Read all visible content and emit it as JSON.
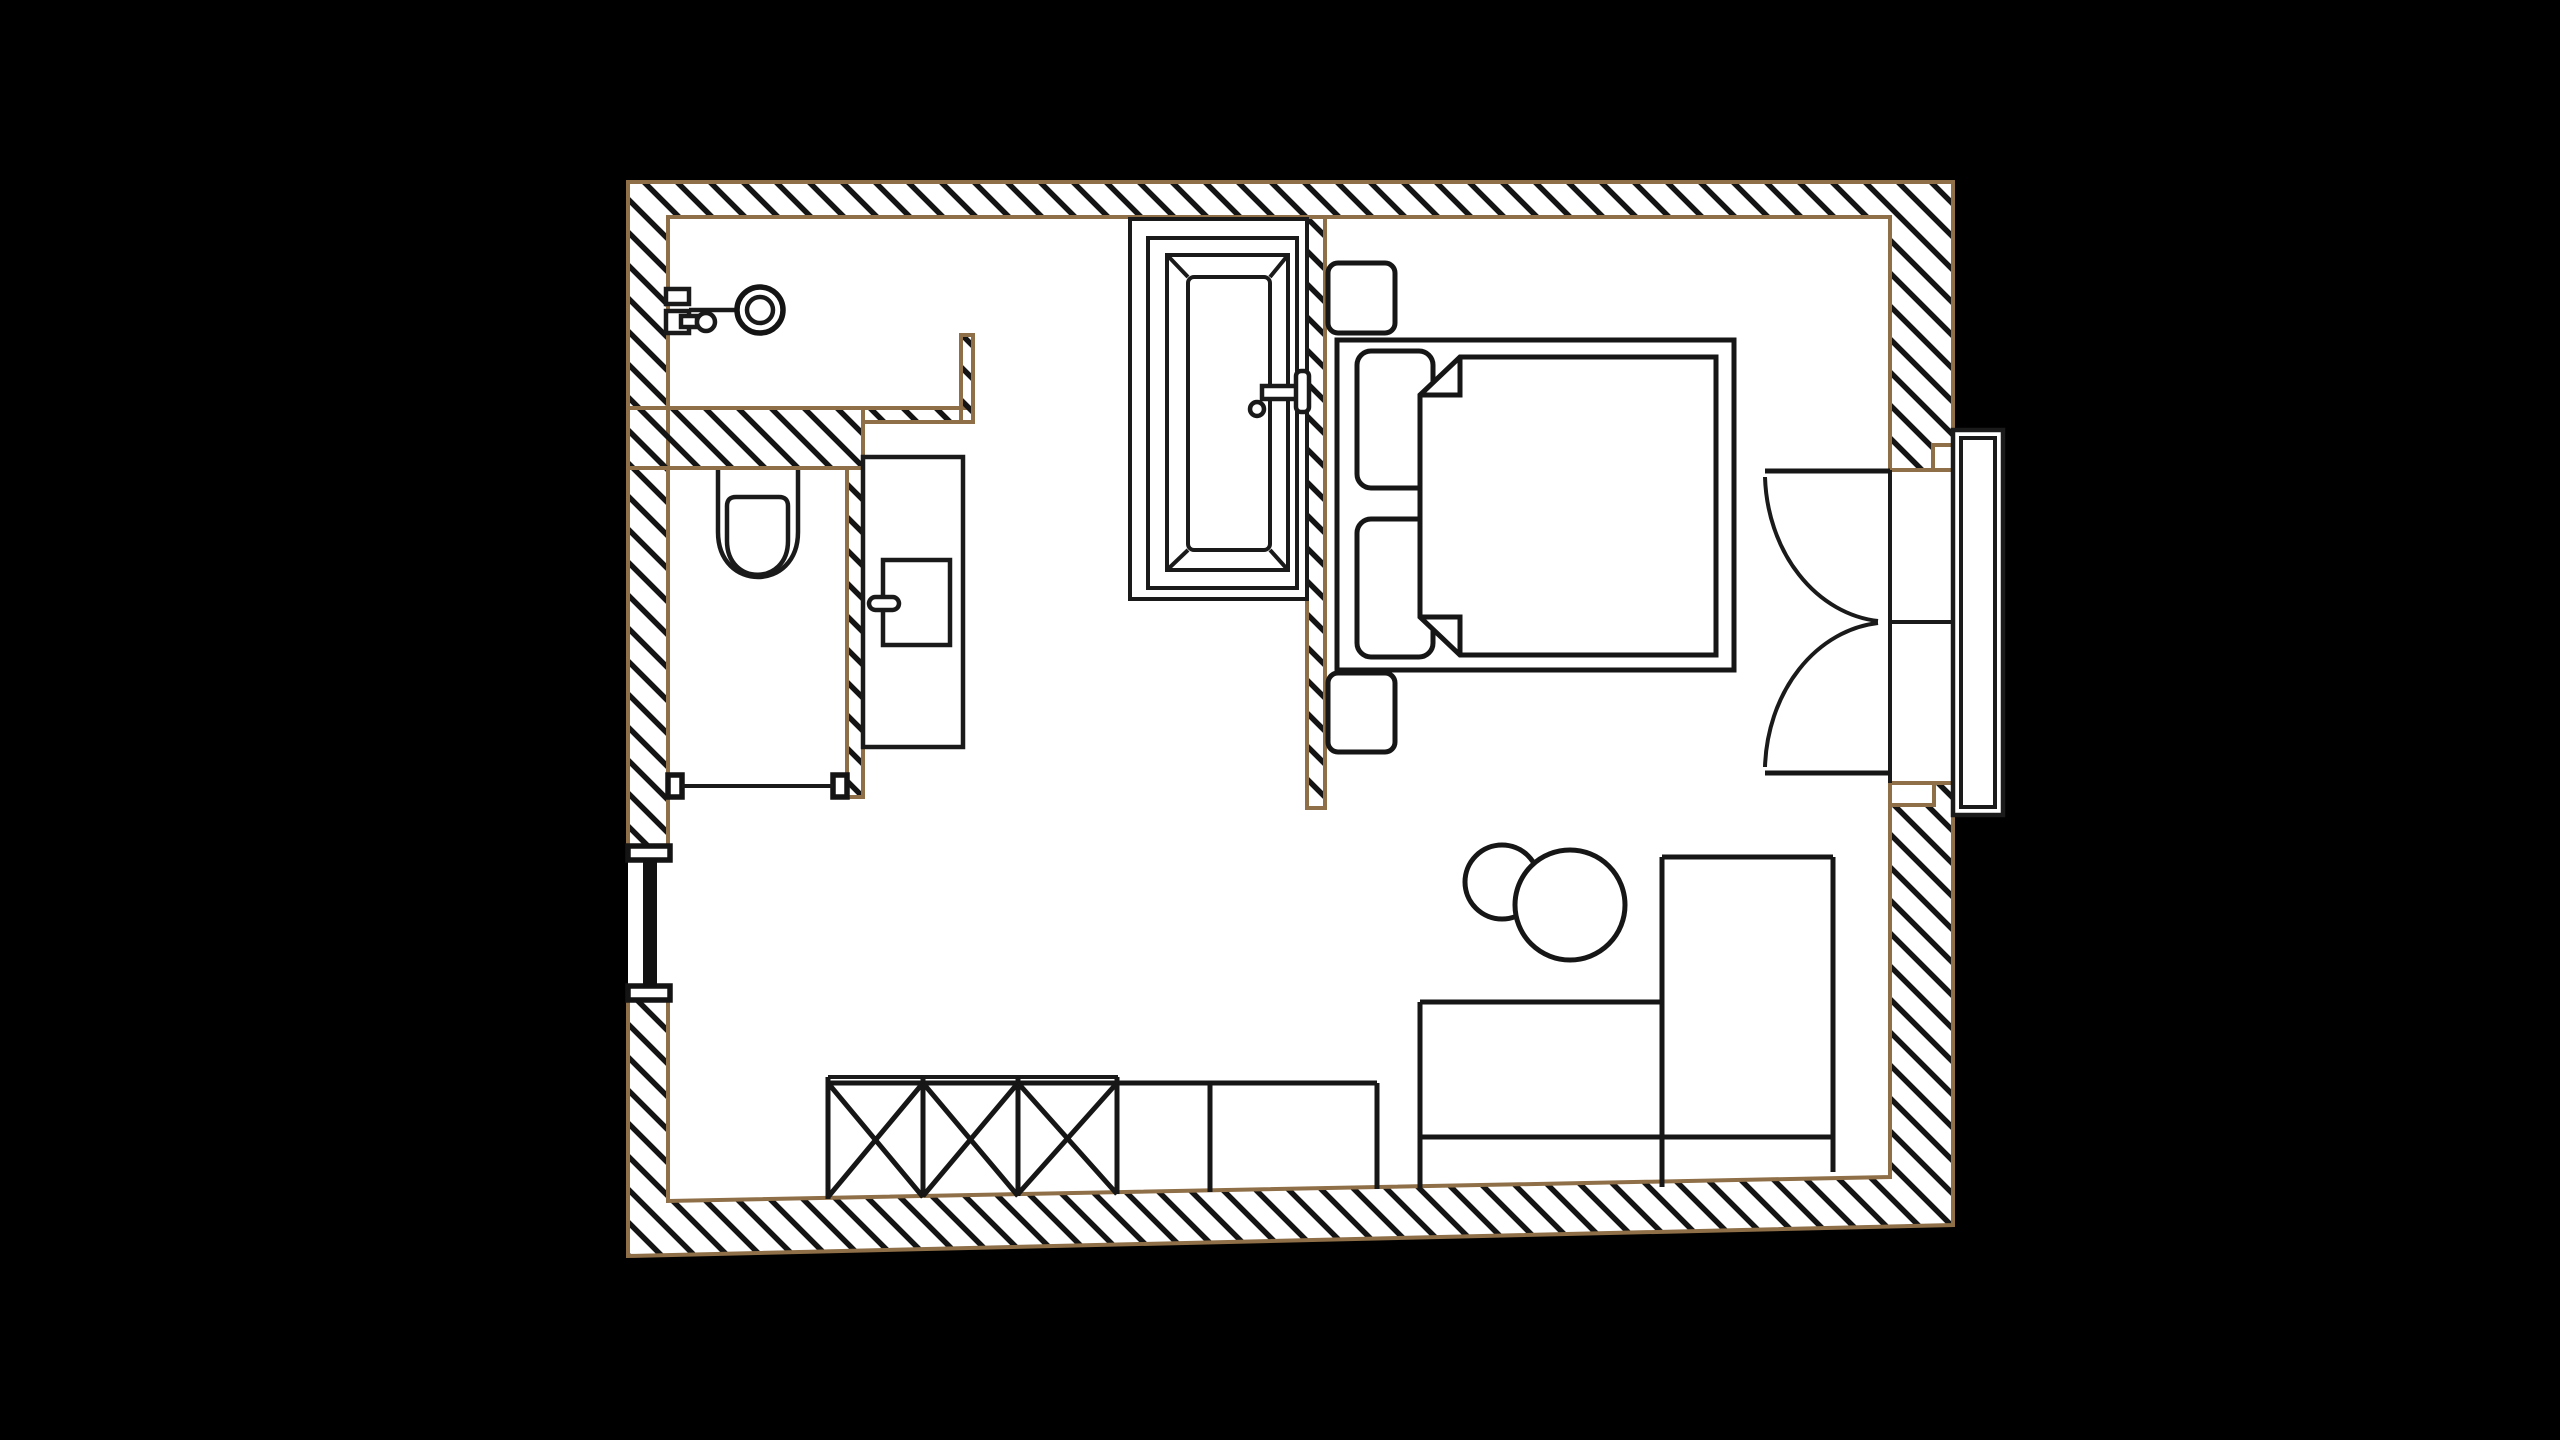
{
  "title": "apartment-floor-plan",
  "canvas": {
    "width": 2560,
    "height": 1440,
    "background": "#000000"
  },
  "palette": {
    "wall_outline": "#8e6f47",
    "hatch_line": "#141414",
    "fixture_line": "#1a1a1a",
    "floor": "#ffffff",
    "outside": "#000000"
  },
  "drawing": {
    "type": "architectural-floor-plan",
    "text_labels": [],
    "rooms": [
      {
        "name": "bathroom",
        "fixtures": [
          "wall-faucet",
          "bathtub"
        ]
      },
      {
        "name": "toilet-room",
        "fixtures": [
          "toilet",
          "door-opening"
        ]
      },
      {
        "name": "hallway",
        "fixtures": [
          "vanity-counter",
          "vanity-cabinet",
          "left-window"
        ]
      },
      {
        "name": "bedroom",
        "fixtures": [
          "double-bed",
          "pillow",
          "pillow",
          "duvet",
          "nightstand",
          "nightstand",
          "french-window",
          "window-sill"
        ]
      },
      {
        "name": "living-area",
        "fixtures": [
          "side-table",
          "side-table",
          "desk",
          "tall-cabinet",
          "x-front-wardrobe"
        ]
      }
    ]
  }
}
